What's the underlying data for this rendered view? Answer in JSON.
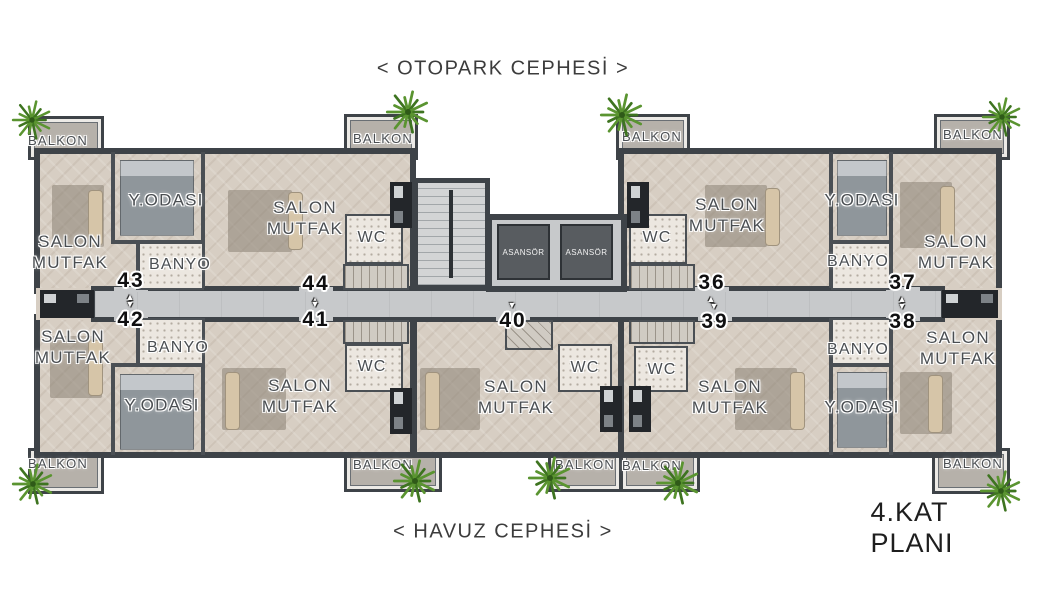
{
  "header": {
    "top_facade_label": "< OTOPARK CEPHESİ >"
  },
  "footer": {
    "bottom_facade_label": "< HAVUZ CEPHESİ >",
    "plan_title": "4.KAT PLANI"
  },
  "colors": {
    "wall": "#3e4348",
    "interior_wall": "#4a4f54",
    "floor": "#d7cec3",
    "corridor": "#c7c9cb",
    "balcony_floor": "#b6b1aa",
    "elevator": "#585c60",
    "label_text": "#4a4e52",
    "plant_green": "#5a9430"
  },
  "plan": {
    "room_labels": [
      {
        "name": "balkon-label",
        "text": "BALKON",
        "x": 58,
        "y": 141,
        "fs": 13
      },
      {
        "name": "balkon-label",
        "text": "BALKON",
        "x": 383,
        "y": 139,
        "fs": 13
      },
      {
        "name": "balkon-label",
        "text": "BALKON",
        "x": 652,
        "y": 137,
        "fs": 13
      },
      {
        "name": "balkon-label",
        "text": "BALKON",
        "x": 973,
        "y": 135,
        "fs": 13
      },
      {
        "name": "balkon-label",
        "text": "BALKON",
        "x": 58,
        "y": 464,
        "fs": 13
      },
      {
        "name": "balkon-label",
        "text": "BALKON",
        "x": 383,
        "y": 465,
        "fs": 13
      },
      {
        "name": "balkon-label",
        "text": "BALKON",
        "x": 585,
        "y": 465,
        "fs": 13
      },
      {
        "name": "balkon-label",
        "text": "BALKON",
        "x": 652,
        "y": 466,
        "fs": 13
      },
      {
        "name": "balkon-label",
        "text": "BALKON",
        "x": 973,
        "y": 464,
        "fs": 13
      },
      {
        "name": "salon-mutfak-label",
        "text": "SALON\nMUTFAK",
        "x": 70,
        "y": 252,
        "fs": 17
      },
      {
        "name": "salon-mutfak-label",
        "text": "SALON\nMUTFAK",
        "x": 305,
        "y": 218,
        "fs": 17
      },
      {
        "name": "salon-mutfak-label",
        "text": "SALON\nMUTFAK",
        "x": 727,
        "y": 215,
        "fs": 17
      },
      {
        "name": "salon-mutfak-label",
        "text": "SALON\nMUTFAK",
        "x": 956,
        "y": 252,
        "fs": 17
      },
      {
        "name": "salon-mutfak-label",
        "text": "SALON\nMUTFAK",
        "x": 73,
        "y": 347,
        "fs": 17
      },
      {
        "name": "salon-mutfak-label",
        "text": "SALON\nMUTFAK",
        "x": 300,
        "y": 396,
        "fs": 17
      },
      {
        "name": "salon-mutfak-label",
        "text": "SALON\nMUTFAK",
        "x": 516,
        "y": 397,
        "fs": 17
      },
      {
        "name": "salon-mutfak-label",
        "text": "SALON\nMUTFAK",
        "x": 730,
        "y": 397,
        "fs": 17
      },
      {
        "name": "salon-mutfak-label",
        "text": "SALON\nMUTFAK",
        "x": 958,
        "y": 348,
        "fs": 17
      },
      {
        "name": "yodasi-label",
        "text": "Y.ODASI",
        "x": 166,
        "y": 200,
        "fs": 17
      },
      {
        "name": "yodasi-label",
        "text": "Y.ODASI",
        "x": 862,
        "y": 200,
        "fs": 17
      },
      {
        "name": "yodasi-label",
        "text": "Y.ODASI",
        "x": 162,
        "y": 405,
        "fs": 17
      },
      {
        "name": "yodasi-label",
        "text": "Y.ODASI",
        "x": 862,
        "y": 407,
        "fs": 17
      },
      {
        "name": "banyo-label",
        "text": "BANYO",
        "x": 180,
        "y": 265,
        "fs": 16
      },
      {
        "name": "banyo-label",
        "text": "BANYO",
        "x": 858,
        "y": 262,
        "fs": 16
      },
      {
        "name": "banyo-label",
        "text": "BANYO",
        "x": 178,
        "y": 348,
        "fs": 16
      },
      {
        "name": "banyo-label",
        "text": "BANYO",
        "x": 858,
        "y": 350,
        "fs": 16
      },
      {
        "name": "wc-label",
        "text": "WC",
        "x": 372,
        "y": 238,
        "fs": 16
      },
      {
        "name": "wc-label",
        "text": "WC",
        "x": 657,
        "y": 238,
        "fs": 16
      },
      {
        "name": "wc-label",
        "text": "WC",
        "x": 372,
        "y": 367,
        "fs": 16
      },
      {
        "name": "wc-label",
        "text": "WC",
        "x": 585,
        "y": 368,
        "fs": 16
      },
      {
        "name": "wc-label",
        "text": "WC",
        "x": 662,
        "y": 370,
        "fs": 16
      }
    ],
    "unit_numbers": [
      {
        "num": "43",
        "x": 131,
        "y": 281,
        "row": "top"
      },
      {
        "num": "44",
        "x": 316,
        "y": 284,
        "row": "top"
      },
      {
        "num": "36",
        "x": 712,
        "y": 283,
        "row": "top"
      },
      {
        "num": "37",
        "x": 903,
        "y": 283,
        "row": "top"
      },
      {
        "num": "42",
        "x": 131,
        "y": 320,
        "row": "bottom"
      },
      {
        "num": "41",
        "x": 316,
        "y": 320,
        "row": "bottom"
      },
      {
        "num": "40",
        "x": 513,
        "y": 321,
        "row": "bottom"
      },
      {
        "num": "39",
        "x": 715,
        "y": 322,
        "row": "bottom"
      },
      {
        "num": "38",
        "x": 903,
        "y": 322,
        "row": "bottom"
      }
    ],
    "elevators": [
      {
        "label": "ASANSÖR"
      },
      {
        "label": "ASANSÖR"
      }
    ],
    "plants": [
      {
        "x": 32,
        "y": 120,
        "s": 42
      },
      {
        "x": 408,
        "y": 112,
        "s": 46
      },
      {
        "x": 622,
        "y": 115,
        "s": 46
      },
      {
        "x": 1002,
        "y": 117,
        "s": 42
      },
      {
        "x": 33,
        "y": 484,
        "s": 44
      },
      {
        "x": 415,
        "y": 481,
        "s": 46
      },
      {
        "x": 550,
        "y": 478,
        "s": 46
      },
      {
        "x": 678,
        "y": 483,
        "s": 46
      },
      {
        "x": 1001,
        "y": 491,
        "s": 44
      }
    ]
  }
}
